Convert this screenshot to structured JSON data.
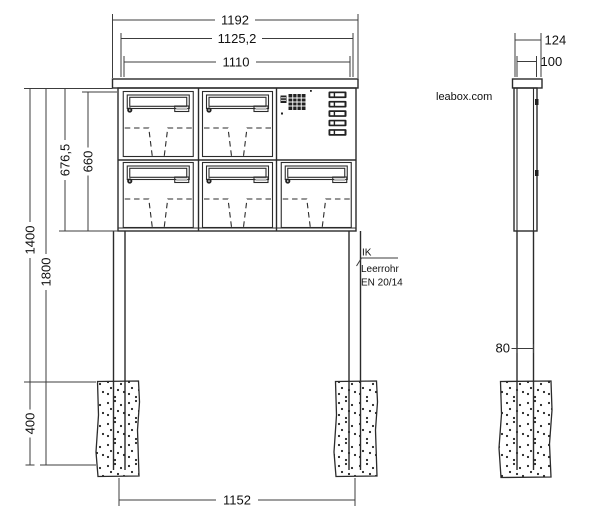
{
  "brand": {
    "label": "leabox.com"
  },
  "callout": {
    "line1": "IK",
    "line2": "Leerrohr",
    "line3": "EN 20/14"
  },
  "front": {
    "dim_width_outer": "1192",
    "dim_width_mid": "1125,2",
    "dim_width_body": "1110",
    "dim_height_box_outer": "676,5",
    "dim_height_box_inner": "660",
    "dim_height_ground": "1400",
    "dim_height_total": "1800",
    "dim_foundation_depth": "400",
    "dim_post_spacing": "1152"
  },
  "side": {
    "dim_depth_roof": "124",
    "dim_depth_body": "100",
    "dim_post_depth": "80"
  }
}
